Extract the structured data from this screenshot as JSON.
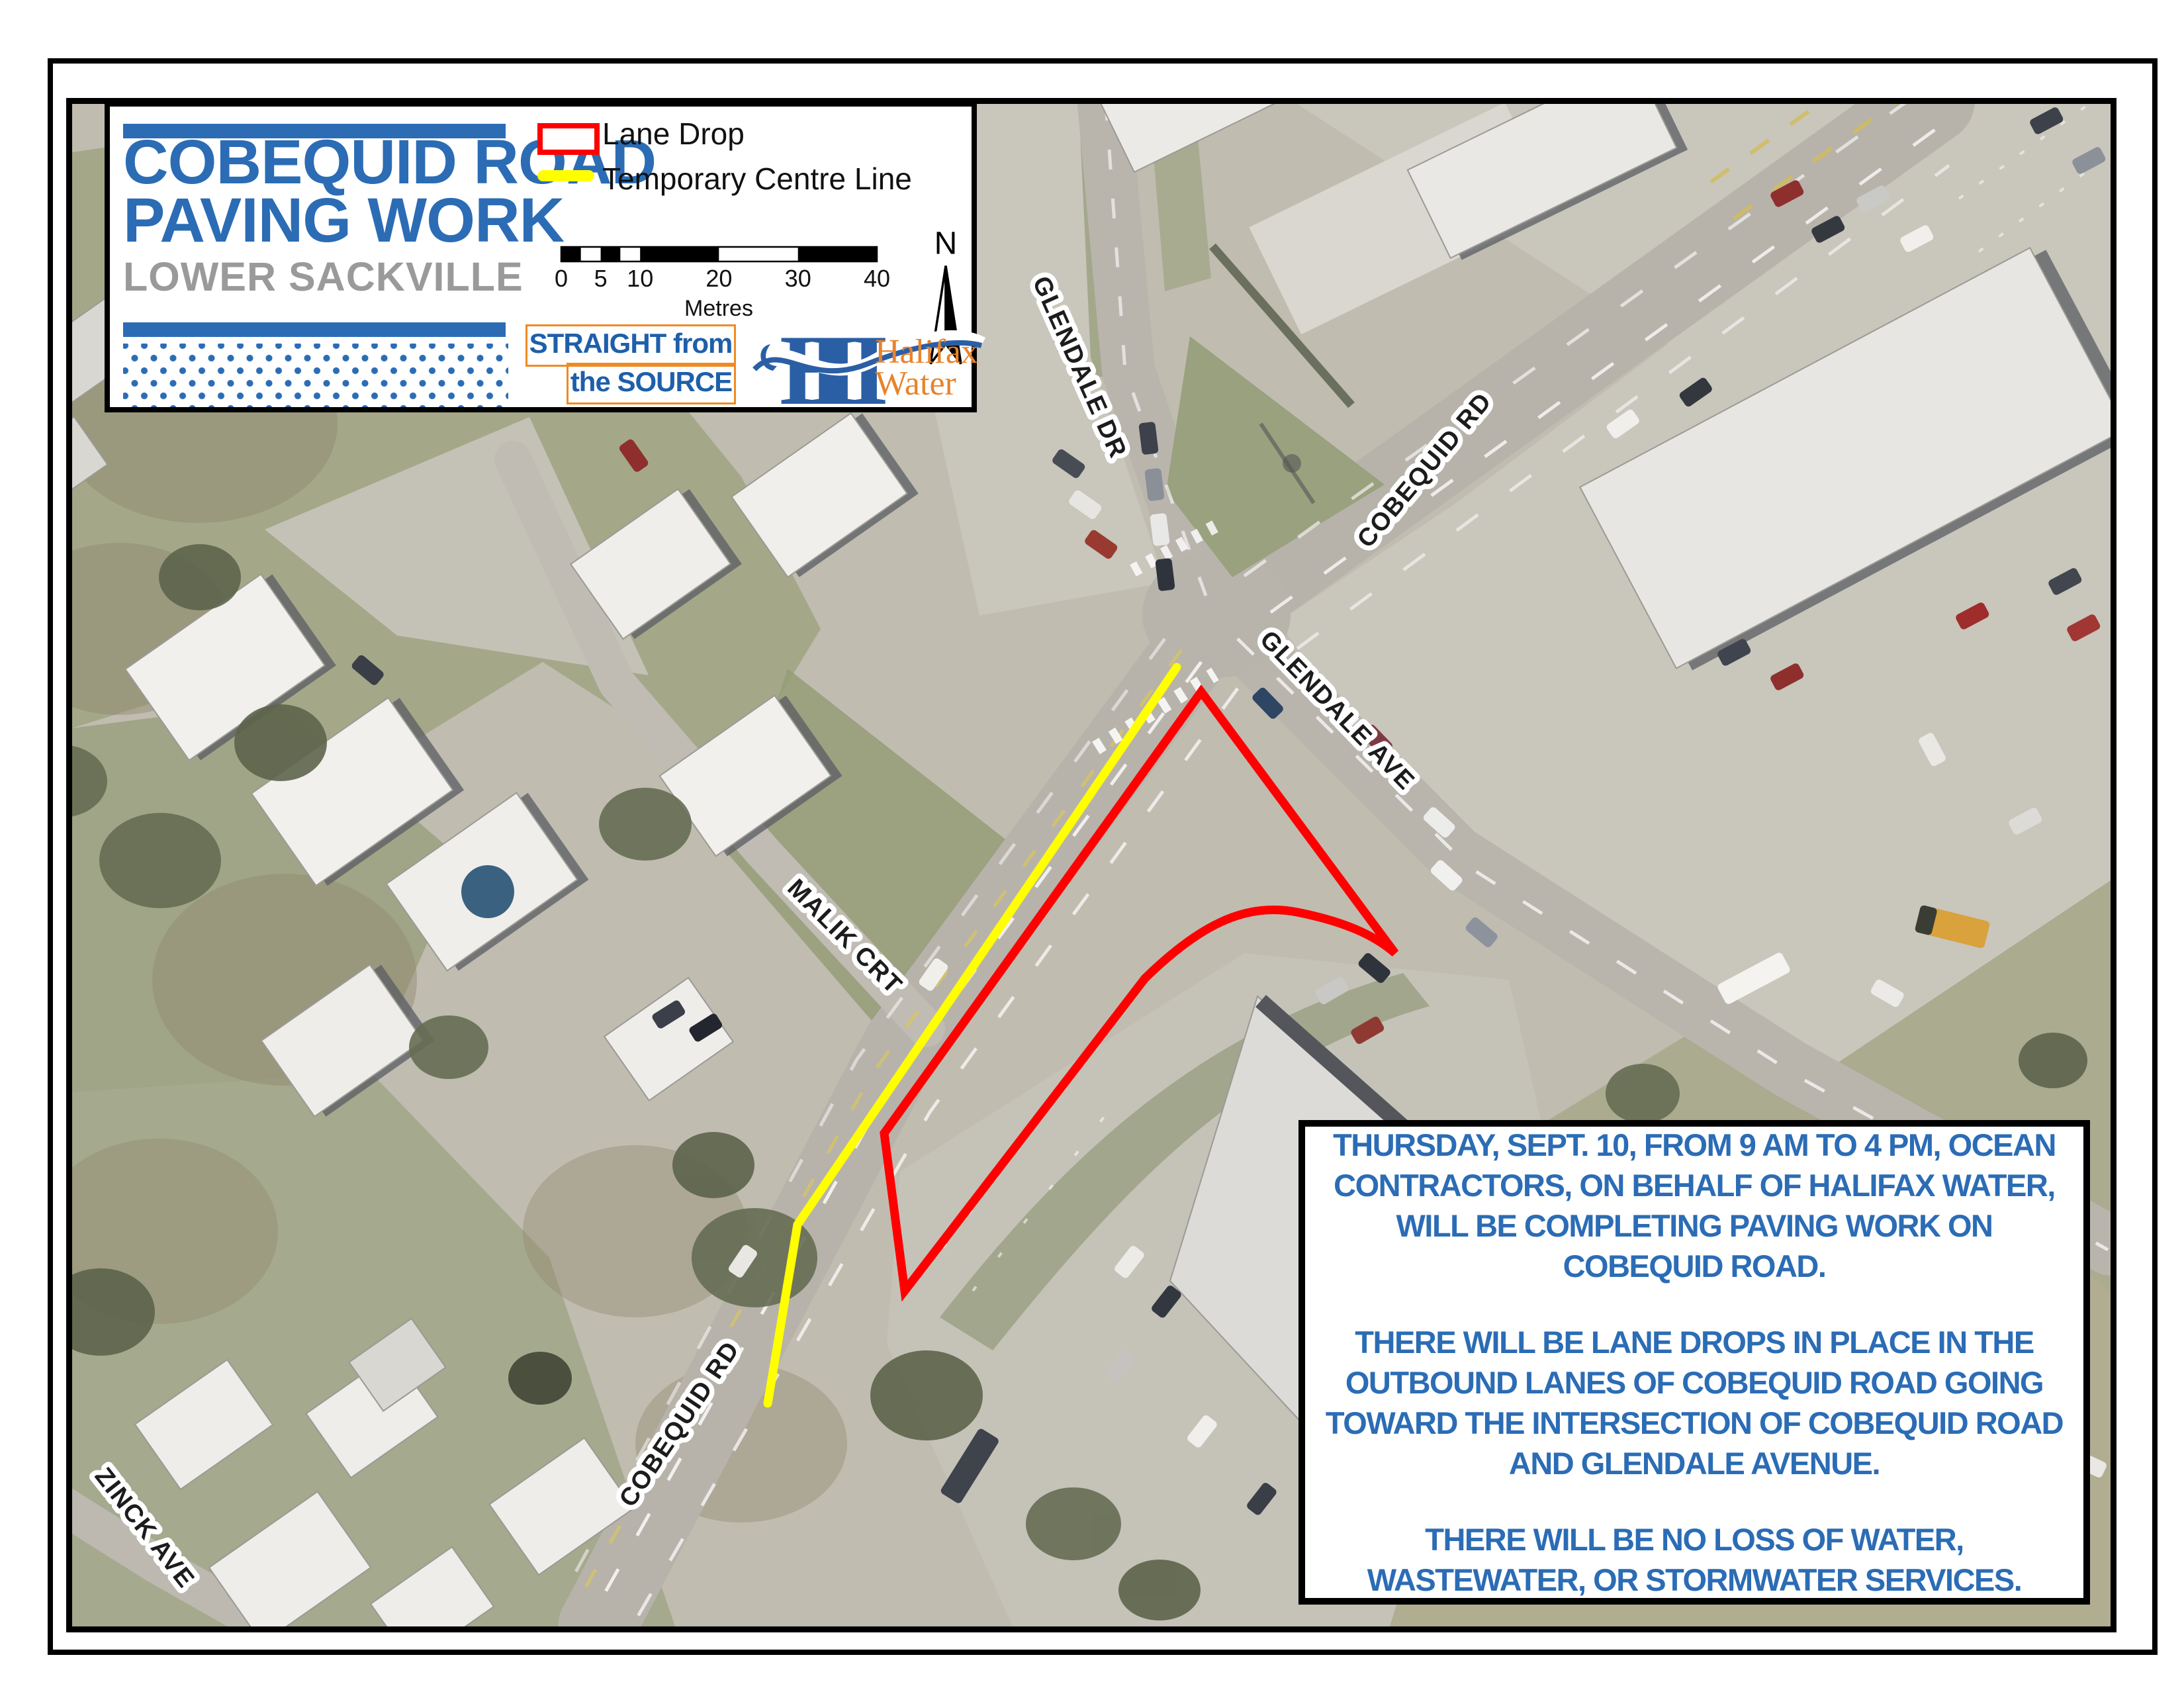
{
  "title_box": {
    "title_line1": "COBEQUID ROAD",
    "title_line2": "PAVING WORK",
    "subtitle": "LOWER SACKVILLE"
  },
  "legend": {
    "items": [
      {
        "label": "Lane Drop",
        "swatch": "red-rectangle-outline",
        "color": "#fe0000"
      },
      {
        "label": "Temporary Centre Line",
        "swatch": "yellow-line",
        "color": "#ffff00"
      }
    ],
    "scale_bar": {
      "ticks": [
        "0",
        "5",
        "10",
        "20",
        "30",
        "40"
      ],
      "unit": "Metres"
    },
    "north_label": "N"
  },
  "branding": {
    "straight_from_the_source": {
      "line1": "STRAIGHT from",
      "line2": "the SOURCE"
    },
    "halifax_water": {
      "monogram": "H",
      "name_line1": "Halifax",
      "name_line2": "Water"
    }
  },
  "map": {
    "street_labels": [
      {
        "text": "GLENDALE DR"
      },
      {
        "text": "COBEQUID RD"
      },
      {
        "text": "GLENDALE AVE"
      },
      {
        "text": "MALIK CRT"
      },
      {
        "text": "COBEQUID RD"
      },
      {
        "text": "ZINCK AVE"
      }
    ],
    "overlays": [
      {
        "name": "lane-drop-area",
        "color": "#fe0000"
      },
      {
        "name": "temporary-centre-line",
        "color": "#ffff00"
      }
    ]
  },
  "notice_box": {
    "paragraphs": [
      "THURSDAY, SEPT. 10, FROM 9 AM TO 4 PM, OCEAN CONTRACTORS, ON BEHALF OF HALIFAX WATER, WILL BE COMPLETING PAVING WORK ON COBEQUID ROAD.",
      "THERE WILL BE LANE DROPS IN PLACE IN THE OUTBOUND LANES OF COBEQUID ROAD GOING TOWARD THE INTERSECTION OF COBEQUID ROAD AND GLENDALE AVENUE.",
      "THERE WILL BE NO LOSS OF WATER, WASTEWATER, OR STORMWATER SERVICES."
    ]
  },
  "colors": {
    "brand_blue": "#2b6cb5",
    "subtitle_gray": "#9a9a9a",
    "accent_orange": "#ee8b28",
    "lane_drop_red": "#fe0000",
    "centre_line_yellow": "#ffff00"
  }
}
